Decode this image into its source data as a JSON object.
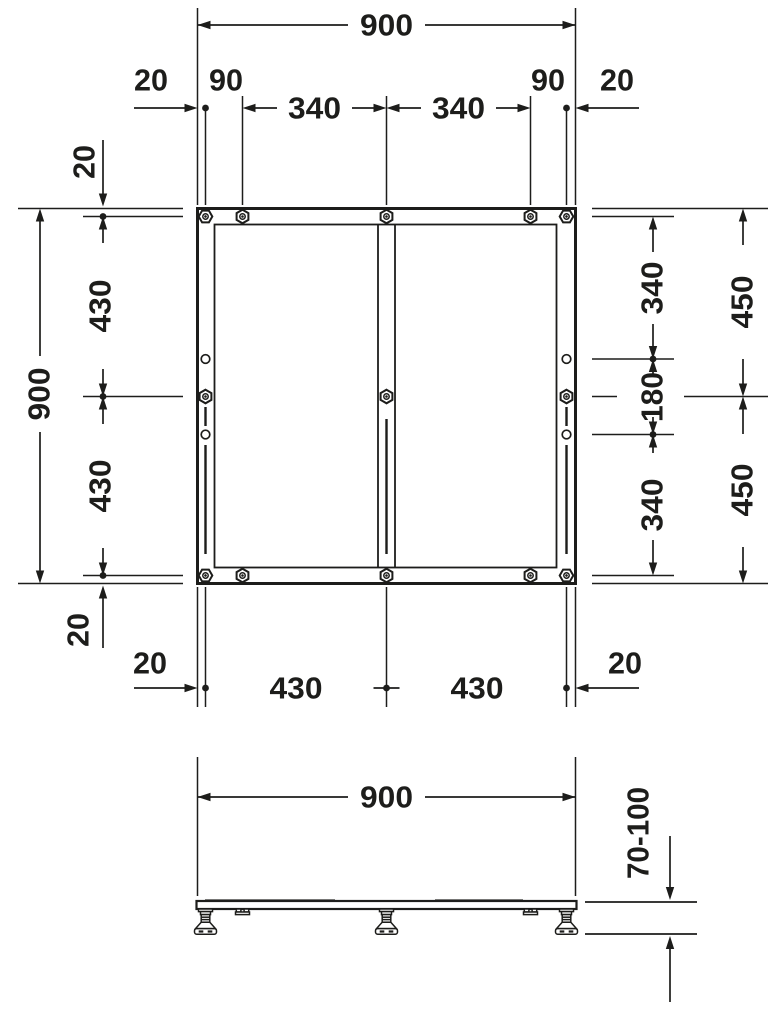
{
  "drawing": {
    "background": "#ffffff",
    "line_color": "#1d1d1b",
    "top_view": {
      "overall_width": "900",
      "overall_height": "900",
      "top_chain": {
        "a20_left": "20",
        "a90_left": "90",
        "a340_left": "340",
        "a340_right": "340",
        "a90_right": "90",
        "a20_right": "20"
      },
      "left_chain": {
        "a20_top": "20",
        "a430_top": "430",
        "a430_bottom": "430",
        "a20_bottom": "20"
      },
      "right_inner_chain": {
        "a340_top": "340",
        "a180_mid": "180",
        "a340_bottom": "340"
      },
      "right_outer_chain": {
        "a450_top": "450",
        "a450_bottom": "450"
      },
      "bottom_chain": {
        "a20_left": "20",
        "a430_left": "430",
        "a430_right": "430",
        "a20_right": "20"
      }
    },
    "side_view": {
      "overall_width": "900",
      "height_range": "70-100"
    }
  }
}
